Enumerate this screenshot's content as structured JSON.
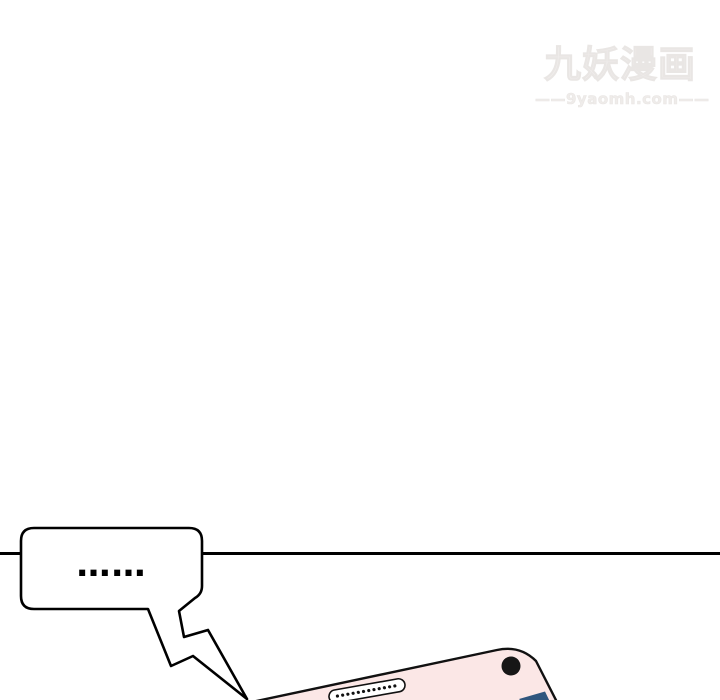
{
  "watermark": {
    "title": "九妖漫画",
    "domain": "——9yaomh.com——"
  },
  "speech_bubble": {
    "text": "……"
  },
  "colors": {
    "background": "#ffffff",
    "line_black": "#000000",
    "outline_black": "#111111",
    "bubble_white": "#ffffff",
    "phone_pink": "#fbe7e6",
    "camera_black": "#161616",
    "speaker_white": "#ffffff",
    "logo_blue": "#2f567e",
    "watermark_gray": "#f0edec"
  }
}
